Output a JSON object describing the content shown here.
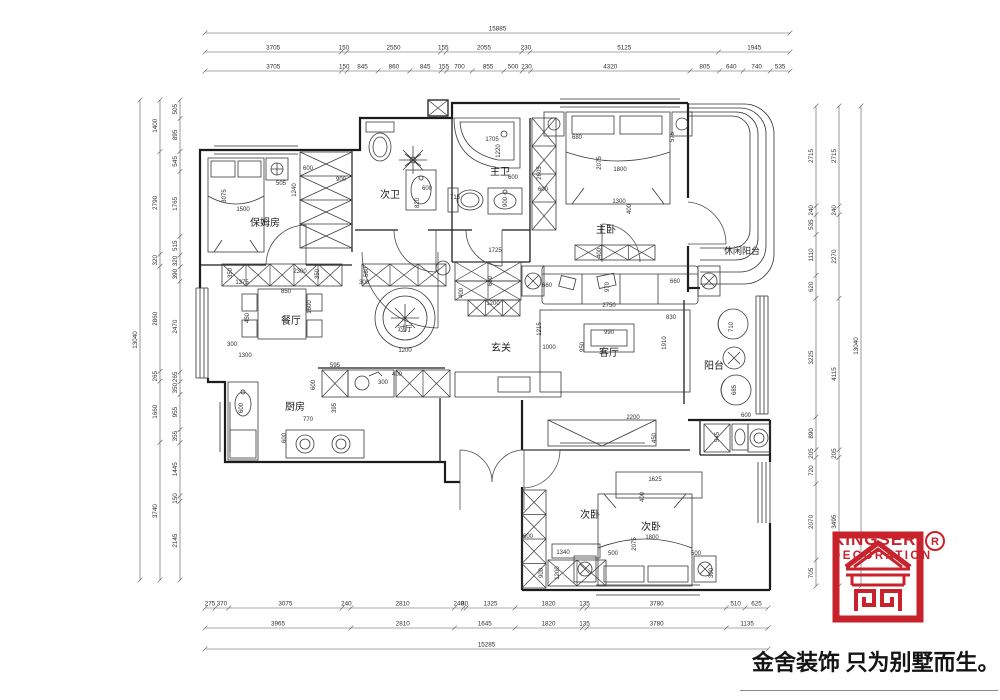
{
  "logo": {
    "brand": "KINGSER'",
    "sub": "DECORATION",
    "registered": "R",
    "tagline": "金舍装饰 只为别墅而生。",
    "accent_color": "#c8232c"
  },
  "rooms": [
    {
      "t": "保姆房",
      "x": 265,
      "y": 226,
      "fs": 10
    },
    {
      "t": "次卫",
      "x": 390,
      "y": 198,
      "fs": 10
    },
    {
      "t": "主卫",
      "x": 500,
      "y": 175,
      "fs": 10
    },
    {
      "t": "主卧",
      "x": 606,
      "y": 233,
      "fs": 10
    },
    {
      "t": "休闲阳台",
      "x": 742,
      "y": 254,
      "fs": 9
    },
    {
      "t": "餐厅",
      "x": 291,
      "y": 324,
      "fs": 10
    },
    {
      "t": "过厅",
      "x": 405,
      "y": 331,
      "fs": 7.5
    },
    {
      "t": "玄关",
      "x": 501,
      "y": 351,
      "fs": 10
    },
    {
      "t": "客厅",
      "x": 609,
      "y": 356,
      "fs": 10
    },
    {
      "t": "阳台",
      "x": 714,
      "y": 369,
      "fs": 10
    },
    {
      "t": "厨房",
      "x": 295,
      "y": 410,
      "fs": 10
    },
    {
      "t": "次卧",
      "x": 590,
      "y": 518,
      "fs": 10
    },
    {
      "t": "次卧",
      "x": 651,
      "y": 530,
      "fs": 10
    }
  ],
  "dim_rows": [
    {
      "orient": "h",
      "pos": 33,
      "from": 205,
      "to": 790,
      "values": [
        "15885"
      ]
    },
    {
      "orient": "h",
      "pos": 52,
      "from": 205,
      "to": 790,
      "values": [
        "3705",
        "150",
        "2550",
        "155",
        "2055",
        "230",
        "5125",
        "1945"
      ]
    },
    {
      "orient": "h",
      "pos": 71,
      "from": 205,
      "to": 790,
      "values": [
        "3705",
        "150",
        "845",
        "860",
        "845",
        "155",
        "700",
        "855",
        "500",
        "230",
        "4320",
        "805",
        "640",
        "740",
        "535"
      ]
    },
    {
      "orient": "h",
      "pos": 608,
      "from": 205,
      "to": 768,
      "values": [
        "275",
        "370",
        "3075",
        "240",
        "2810",
        "240",
        "80",
        "1325",
        "1820",
        "135",
        "3780",
        "510",
        "625"
      ]
    },
    {
      "orient": "h",
      "pos": 628,
      "from": 205,
      "to": 768,
      "values": [
        "3965",
        "2810",
        "1645",
        "1820",
        "135",
        "3780",
        "1135"
      ]
    },
    {
      "orient": "h",
      "pos": 649,
      "from": 205,
      "to": 768,
      "values": [
        "15285"
      ]
    },
    {
      "orient": "v",
      "pos": 140,
      "from": 100,
      "to": 580,
      "values": [
        "13040"
      ]
    },
    {
      "orient": "v",
      "pos": 160,
      "from": 100,
      "to": 580,
      "values": [
        "1400",
        "2790",
        "320",
        "2860",
        "265",
        "1660",
        "3740"
      ]
    },
    {
      "orient": "v",
      "pos": 180,
      "from": 100,
      "to": 580,
      "values": [
        "505",
        "895",
        "545",
        "1765",
        "515",
        "320",
        "390",
        "2470",
        "265",
        "350",
        "955",
        "355",
        "1445",
        "150",
        "2145"
      ]
    },
    {
      "orient": "v",
      "pos": 816,
      "from": 106,
      "to": 586,
      "values": [
        "2715",
        "240",
        "535",
        "1110",
        "620",
        "3225",
        "890",
        "205",
        "720",
        "2070",
        "705"
      ]
    },
    {
      "orient": "v",
      "pos": 839,
      "from": 106,
      "to": 586,
      "values": [
        "2715",
        "240",
        "2270",
        "4115",
        "205",
        "3495"
      ]
    },
    {
      "orient": "v",
      "pos": 861,
      "from": 106,
      "to": 586,
      "values": [
        "13040"
      ]
    }
  ],
  "inline_dims": [
    {
      "t": "3075",
      "x": 226,
      "y": 196,
      "v": 1
    },
    {
      "t": "1500",
      "x": 243,
      "y": 211
    },
    {
      "t": "505",
      "x": 281,
      "y": 185
    },
    {
      "t": "600",
      "x": 308,
      "y": 170
    },
    {
      "t": "900",
      "x": 341,
      "y": 181
    },
    {
      "t": "1240",
      "x": 296,
      "y": 190,
      "v": 1
    },
    {
      "t": "600",
      "x": 427,
      "y": 190
    },
    {
      "t": "820",
      "x": 419,
      "y": 203,
      "v": 1
    },
    {
      "t": "715",
      "x": 455,
      "y": 199
    },
    {
      "t": "1705",
      "x": 492,
      "y": 141
    },
    {
      "t": "1220",
      "x": 500,
      "y": 151,
      "v": 1
    },
    {
      "t": "600",
      "x": 513,
      "y": 179
    },
    {
      "t": "900",
      "x": 507,
      "y": 202,
      "v": 1
    },
    {
      "t": "2605",
      "x": 541,
      "y": 173,
      "v": 1
    },
    {
      "t": "600",
      "x": 543,
      "y": 191
    },
    {
      "t": "680",
      "x": 577,
      "y": 139
    },
    {
      "t": "575",
      "x": 674,
      "y": 137,
      "v": 1
    },
    {
      "t": "2075",
      "x": 601,
      "y": 163,
      "v": 1
    },
    {
      "t": "1800",
      "x": 620,
      "y": 171
    },
    {
      "t": "1300",
      "x": 619,
      "y": 203
    },
    {
      "t": "400",
      "x": 631,
      "y": 209,
      "v": 1
    },
    {
      "t": "400",
      "x": 601,
      "y": 253,
      "v": 1
    },
    {
      "t": "1725",
      "x": 495,
      "y": 252
    },
    {
      "t": "600",
      "x": 492,
      "y": 281,
      "v": 1
    },
    {
      "t": "400",
      "x": 463,
      "y": 293,
      "v": 1
    },
    {
      "t": "1200",
      "x": 493,
      "y": 305
    },
    {
      "t": "970",
      "x": 609,
      "y": 287,
      "v": 1
    },
    {
      "t": "2750",
      "x": 609,
      "y": 307
    },
    {
      "t": "660",
      "x": 547,
      "y": 287
    },
    {
      "t": "660",
      "x": 675,
      "y": 283
    },
    {
      "t": "1215",
      "x": 541,
      "y": 329,
      "v": 1
    },
    {
      "t": "1000",
      "x": 549,
      "y": 349
    },
    {
      "t": "990",
      "x": 609,
      "y": 334
    },
    {
      "t": "950",
      "x": 584,
      "y": 347,
      "v": 1
    },
    {
      "t": "830",
      "x": 671,
      "y": 319
    },
    {
      "t": "1910",
      "x": 666,
      "y": 343,
      "v": 1
    },
    {
      "t": "350",
      "x": 232,
      "y": 273,
      "v": 1
    },
    {
      "t": "1375",
      "x": 242,
      "y": 284
    },
    {
      "t": "2300",
      "x": 300,
      "y": 273
    },
    {
      "t": "350",
      "x": 319,
      "y": 274,
      "v": 1
    },
    {
      "t": "850",
      "x": 286,
      "y": 293
    },
    {
      "t": "560",
      "x": 368,
      "y": 272,
      "v": 1
    },
    {
      "t": "300",
      "x": 364,
      "y": 284
    },
    {
      "t": "450",
      "x": 249,
      "y": 318,
      "v": 1
    },
    {
      "t": "1600",
      "x": 311,
      "y": 307,
      "v": 1
    },
    {
      "t": "1200",
      "x": 405,
      "y": 352
    },
    {
      "t": "300",
      "x": 232,
      "y": 346
    },
    {
      "t": "1300",
      "x": 245,
      "y": 357
    },
    {
      "t": "595",
      "x": 335,
      "y": 367
    },
    {
      "t": "600",
      "x": 315,
      "y": 385,
      "v": 1
    },
    {
      "t": "300",
      "x": 383,
      "y": 384
    },
    {
      "t": "400",
      "x": 397,
      "y": 376
    },
    {
      "t": "395",
      "x": 336,
      "y": 408,
      "v": 1
    },
    {
      "t": "770",
      "x": 308,
      "y": 421
    },
    {
      "t": "600",
      "x": 286,
      "y": 438,
      "v": 1
    },
    {
      "t": "600",
      "x": 243,
      "y": 408,
      "v": 1
    },
    {
      "t": "710",
      "x": 733,
      "y": 327,
      "v": 1
    },
    {
      "t": "685",
      "x": 736,
      "y": 390,
      "v": 1
    },
    {
      "t": "600",
      "x": 746,
      "y": 417
    },
    {
      "t": "2200",
      "x": 633,
      "y": 419
    },
    {
      "t": "450",
      "x": 656,
      "y": 438,
      "v": 1
    },
    {
      "t": "545",
      "x": 719,
      "y": 437,
      "v": 1
    },
    {
      "t": "1625",
      "x": 655,
      "y": 481
    },
    {
      "t": "400",
      "x": 644,
      "y": 497,
      "v": 1
    },
    {
      "t": "1800",
      "x": 652,
      "y": 539
    },
    {
      "t": "2075",
      "x": 636,
      "y": 544,
      "v": 1
    },
    {
      "t": "500",
      "x": 613,
      "y": 555
    },
    {
      "t": "500",
      "x": 696,
      "y": 555
    },
    {
      "t": "1340",
      "x": 563,
      "y": 554
    },
    {
      "t": "600",
      "x": 528,
      "y": 538
    },
    {
      "t": "900",
      "x": 543,
      "y": 573,
      "v": 1
    },
    {
      "t": "1200",
      "x": 559,
      "y": 573,
      "v": 1
    },
    {
      "t": "300",
      "x": 713,
      "y": 573,
      "v": 1
    }
  ]
}
